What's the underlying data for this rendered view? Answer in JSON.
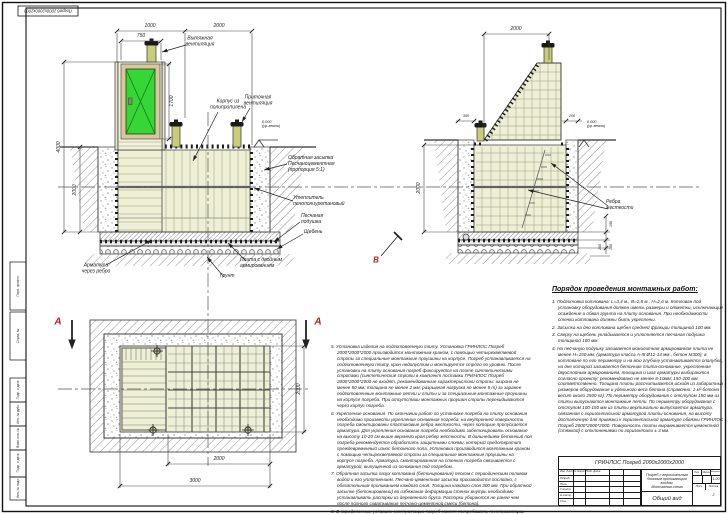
{
  "sheet": {
    "corner_stamp": "Погреб 2000х2000х2000",
    "margin_labels": [
      "Перв. примен.",
      "Справ. №",
      "Подп. и дата",
      "Инв. № дубл.",
      "Взам. инв. №",
      "Подп. и дата",
      "Инв. № подл."
    ]
  },
  "colors": {
    "door_green": "#35d635",
    "body_cream": "#eef0d6",
    "pipe_olive": "#c9cc78",
    "frame_tan": "#d8c79a",
    "section_red": "#bb2222"
  },
  "dims": {
    "f_top1": "1000",
    "f_top2": "2000",
    "f_shaft": "750",
    "f_h": "4000",
    "f_d": "2000",
    "f_door": "1700",
    "s_top": "2000",
    "s_300": "300",
    "s_200": "200",
    "s_left": "2000",
    "s_150": "150",
    "s_100a": "100",
    "s_100b": "100",
    "p_right": "2000",
    "p_b1": "2000",
    "p_b2": "3000"
  },
  "labels": {
    "exhaust": "Вытяжная\nвентиляция",
    "body": "Корпус из\nполипропилена",
    "supply": "Приточная\nвентиляция",
    "backfill": "Обратная засыпка\nПесчаноцементная\n(пропорция 5:1)",
    "insulation": "Утеплитель\nпенополиуретановый",
    "sand": "Песчаная\nподушка",
    "gravel": "Щебень",
    "rebar": "Арматура\nчерез ребро",
    "plate": "Плита с двойным\nармированием",
    "soil": "Грунт",
    "ribs": "Ребра\nжесткости",
    "elev": "0.000\n(ур.земли)"
  },
  "sections": {
    "a": "А",
    "b": "В"
  },
  "notes_left": {
    "items": [
      "5. Установка изделия на подготовленную плиту. Установка ГРИНЛОС Погреб 2000*2000*2000 производится монтажным краном, с помощью четырехветвевой стропы за специальные монтажные проушины на корпусе. Погреб устанавливается на подготовленную плиту, крен недопустим и монтируется строго по уровню. После установки на плиту основания погреб фиксируется на плите синтетическими стропами (синтетические стропы в комплект поставки ГРИНЛОС Погреб 2000*2000*2000 не входят, рекомендованные характеристики стропы: ширина не менее 50 мм; толщина не менее 2 мм; разрывная нагрузка не менее 5 т) за заранее подготовленные монтажные петли и плиты и за специальные монтажные проушины на корпусе погреба. При отсутствии монтажных проушин стропы перекидываются через корпус погреба.",
      "6. Укрепление основания. По окончании работ по установке погреба на плиту основания необходимо произвести укрепление основания погреба: на внутренней поверхности погреба смонтированы пластиковые ребра жесткости, через которые пропускается арматура. Для укрепления основания погреба необходимо забетонировать основание на высоту 10-20 см выше верхнего края ребер жесткости. В дальнейшем бетонный пол погреба рекомендуется обработать защитными слоями, который предотвратит преждевременный износ бетонного пола. Установка производится монтажным краном с помощью четырехветвевой стропы за специальные монтажные проушины на корпусе погреба. Арматура, смонтированная на стенках погреба связывается с арматурой, выпущенной из основания под погребом.",
      "7. Обратная засыпка пазух котлована (бетонирование) песком с периодическим поливом водой и его уплотнением. Песчано-цементная засыпка производится послойно, с обязательным проливанием каждого слоя. Толщина каждого слоя 300 мм. При обратной засыпке (бетонировании) во избежание деформации стенок внутрь необходимо устанавливать распорки из деревянного бруса. Распорки убираются не ранее чем после полного схватывания песчано-цементной смеси (бетона).",
      "8. В определенных условиях эксплуатации погреб может потребовать теплоизоляции, как правило, это горизонтальный теплоизоляционный слой из материала, использование которого допустимо в несвязанном грунте, уложенный на верхнее пластиковое горизонтальное перекрытие ГРИНЛОС Погреб 2000*2000*2000."
    ]
  },
  "notes_right": {
    "title": "Порядок проведения монтажных работ:",
    "items": [
      "1. Подготовка котлована: L=3,4 м., B=2,6 м., H=2,6 м. Котлован под установку оборудования должен иметь размеры и отметки, исключающие осаждение и обвал грунта на плиту основания. При необходимости стенки котлована должны быть укреплены.",
      "2. Засыпка на дно котлована щебня средней фракции толщиной 100 мм.",
      "3. Сверху на щебень укладывается и уплотняется песчаная подушка толщиной 100 мм.",
      "4. На песчаную подушку заливается монолитная армированная плита не менее Н=150 мм. (арматура класса А-III Ø12-14 мм., бетон М300); в котловане по его периметру и на всю глубину устанавливается опалубка, на дне которой заливается бетонная плита-основание, укрепленная двухслойным армированием, толщина и шаг арматуры выбираются согласно проекту; рекомендовано не менее 8-10мм; 150-200 мм соответственно. Толщина плиты рассчитывается исходя из габаритных размеров оборудования и удельного веса бетона (справочно: 1 м³ бетона весит около 2500 кг). По периметру оборудования с отступом 150 мм из плиты выпускаются монтажные петли. По периметру оборудования с отступом 100-150 мм из плиты вертикально выпускается арматура, связанная с горизонтальной арматурой плиты основания, на высоту достаточную для привязки к горизонтальной арматуре обвязки ГРИНЛОС Погреб 2000*2000*2000. Поверхность плиты выравнивается цементной (стяжкой) с отклонениями по горизонтали ± 3 мм."
    ]
  },
  "titleblock": {
    "product": "ГРИНЛОС Погреб 2000х2000х2000",
    "description": "Погреб с вертикальным\nбоковым проникающим\nвходом.\nМонтажная схема",
    "view": "Общий вид",
    "scale": "1:20",
    "lit": "Лит.",
    "mass": "Масса",
    "scale_h": "Масштаб",
    "sheet_h": "Лист",
    "sheets_h": "Листов",
    "sheets_v": "2",
    "meta_header": "Изм.  Лист  № докум.  Подп.  Дата",
    "roles": [
      "Разраб.",
      "Пров.",
      "Т.контр.",
      "Н.контр.",
      "Утв."
    ]
  }
}
